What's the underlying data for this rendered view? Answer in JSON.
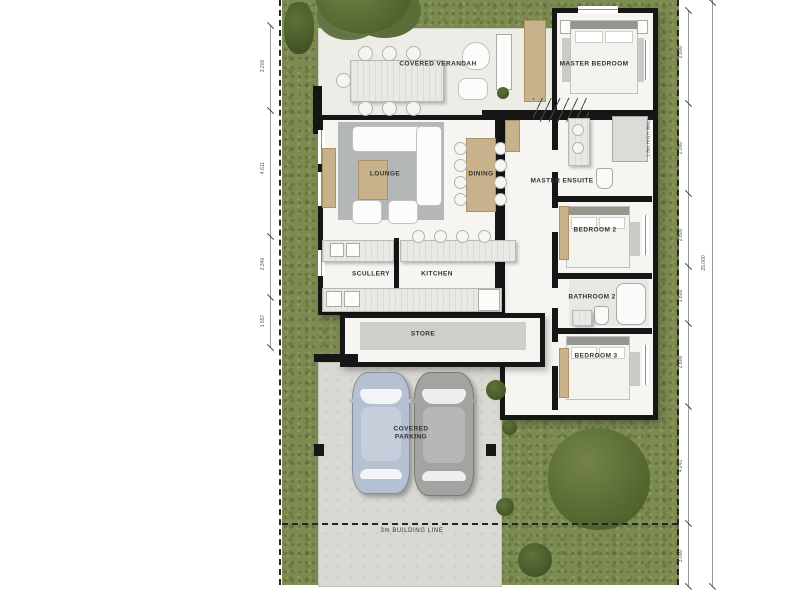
{
  "rooms": {
    "covered_verandah": "COVERED VERANDAH",
    "master_bedroom": "MASTER BEDROOM",
    "master_ensuite": "MASTER ENSUITE",
    "lounge": "LOUNGE",
    "dining": "DINING",
    "scullery": "SCULLERY",
    "kitchen": "KITCHEN",
    "store": "STORE",
    "bedroom_2": "BEDROOM 2",
    "bathroom_2": "BATHROOM 2",
    "bedroom_3": "BEDROOM 3",
    "covered_parking": "COVERED PARKING"
  },
  "annotations": {
    "building_line": "3m BUILDING LINE",
    "boundary_wall_note": "1.8m HIGH WALL"
  },
  "dimensions": {
    "left_chain": [
      "3.200",
      "4.611",
      "2.340",
      "1.557"
    ],
    "right_chain": [
      "2.800",
      "2.090",
      "2.800",
      "1.800",
      "2.800",
      "4.241",
      "3.000"
    ],
    "overall": "25.000"
  },
  "colors": {
    "grass": "#7c8b51",
    "wall": "#161616",
    "floor": "#f6f5f2",
    "verandah_floor": "#edece7",
    "concrete": "#d9d8d3",
    "rug": "#b4b7b8",
    "wood": "#c8b28c",
    "car_left": "#b5c1d0",
    "car_right": "#a3a3a1"
  }
}
